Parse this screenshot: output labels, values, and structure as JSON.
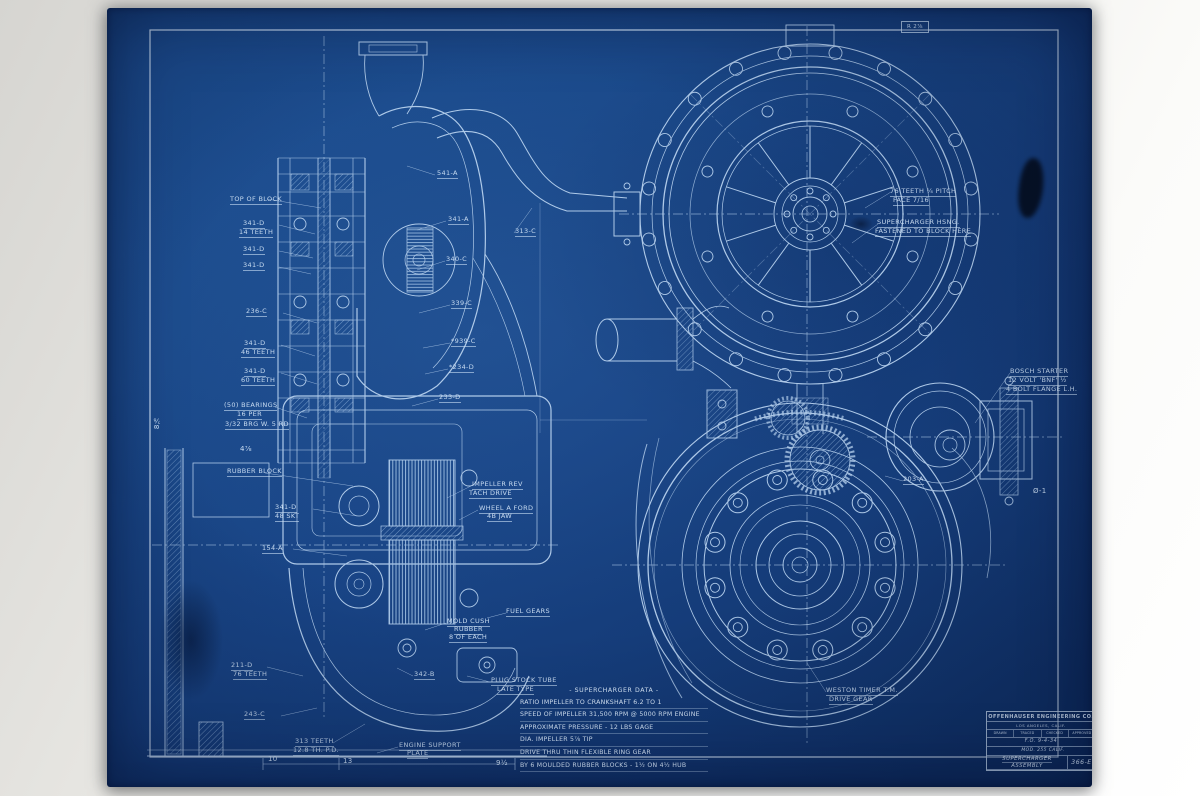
{
  "document": {
    "type": "blueprint-engineering-drawing",
    "sheet_color": "#184384",
    "line_color": "#b7d1ee",
    "text_color": "#d3e5f8"
  },
  "title_block": {
    "company": "OFFENHAUSER ENGINEERING CO.",
    "city": "LOS ANGELES, CALIF.",
    "headers": [
      "DRAWN",
      "TRACED",
      "CHECKED",
      "APPROVED"
    ],
    "values": "F.O.   9-4-34",
    "model": "MOD. 255 CALIF.",
    "title_line1": "SUPERCHARGER",
    "title_line2": "ASSEMBLY",
    "number": "366-E"
  },
  "notes": {
    "lines": [
      "- SUPERCHARGER DATA -",
      "RATIO IMPELLER TO CRANKSHAFT 6.2 TO 1",
      "SPEED OF IMPELLER 31,500 RPM @ 5000 RPM ENGINE",
      "APPROXIMATE PRESSURE - 12 LBS GAGE",
      "DIA. IMPELLER 5⅞ TIP",
      "DRIVE THRU THIN FLEXIBLE RING GEAR",
      "BY 6 MOULDED RUBBER BLOCKS - 1½ ON 4½ HUB"
    ]
  },
  "labels": [
    {
      "t": "TOP OF BLOCK",
      "x": 123,
      "y": 188,
      "u": true
    },
    {
      "t": "341-D",
      "x": 136,
      "y": 212,
      "u": true
    },
    {
      "t": "14 TEETH",
      "x": 132,
      "y": 221,
      "u": true
    },
    {
      "t": "341-D",
      "x": 136,
      "y": 238,
      "u": true
    },
    {
      "t": "341-D",
      "x": 136,
      "y": 254,
      "u": true
    },
    {
      "t": "236-C",
      "x": 139,
      "y": 300,
      "u": true
    },
    {
      "t": "341-D",
      "x": 137,
      "y": 332,
      "u": true
    },
    {
      "t": "46 TEETH",
      "x": 134,
      "y": 341,
      "u": true
    },
    {
      "t": "341-D",
      "x": 137,
      "y": 360,
      "u": true
    },
    {
      "t": "60 TEETH",
      "x": 134,
      "y": 369,
      "u": true
    },
    {
      "t": "(50) BEARINGS",
      "x": 117,
      "y": 394,
      "u": true
    },
    {
      "t": "16 PER",
      "x": 130,
      "y": 403,
      "u": true
    },
    {
      "t": "3/32 BRG W. 5 RD",
      "x": 118,
      "y": 413,
      "u": true
    },
    {
      "t": "4⅞",
      "x": 133,
      "y": 437,
      "cls": "dim"
    },
    {
      "t": "RUBBER BLOCK",
      "x": 120,
      "y": 460,
      "u": true
    },
    {
      "t": "341-D",
      "x": 168,
      "y": 496,
      "u": true
    },
    {
      "t": "48 SKT",
      "x": 168,
      "y": 505,
      "u": true
    },
    {
      "t": "154-A",
      "x": 155,
      "y": 537,
      "u": true
    },
    {
      "t": "8⅞",
      "x": 46,
      "y": 408,
      "cls": "dim vert"
    },
    {
      "t": "211-D",
      "x": 124,
      "y": 654,
      "u": true
    },
    {
      "t": "76 TEETH",
      "x": 126,
      "y": 663,
      "u": true
    },
    {
      "t": "243-C",
      "x": 137,
      "y": 703,
      "u": true
    },
    {
      "t": "313 TEETH",
      "x": 188,
      "y": 730,
      "u": true
    },
    {
      "t": "12.8 TH. P.D.",
      "x": 186,
      "y": 739,
      "u": true
    },
    {
      "t": "541-A",
      "x": 330,
      "y": 162,
      "u": true
    },
    {
      "t": "341-A",
      "x": 341,
      "y": 208,
      "u": true
    },
    {
      "t": "313-C",
      "x": 408,
      "y": 220,
      "u": true
    },
    {
      "t": "340-C",
      "x": 339,
      "y": 248,
      "u": true
    },
    {
      "t": "339-C",
      "x": 344,
      "y": 292,
      "u": true
    },
    {
      "t": "*939-C",
      "x": 344,
      "y": 330,
      "u": true
    },
    {
      "t": "*234-D",
      "x": 342,
      "y": 356,
      "u": true
    },
    {
      "t": "233-D",
      "x": 332,
      "y": 386,
      "u": true
    },
    {
      "t": "IMPELLER REV",
      "x": 365,
      "y": 473,
      "u": true
    },
    {
      "t": "TACH DRIVE",
      "x": 362,
      "y": 482,
      "u": true
    },
    {
      "t": "WHEEL A FORD",
      "x": 372,
      "y": 497,
      "u": true
    },
    {
      "t": "4B JAW",
      "x": 380,
      "y": 505,
      "u": true
    },
    {
      "t": "FUEL GEARS",
      "x": 399,
      "y": 600,
      "u": true
    },
    {
      "t": "MOLD CUSH",
      "x": 340,
      "y": 610,
      "u": true
    },
    {
      "t": "RUBBER",
      "x": 347,
      "y": 618,
      "u": true
    },
    {
      "t": "8 OF EACH",
      "x": 342,
      "y": 626,
      "u": true
    },
    {
      "t": "342-B",
      "x": 307,
      "y": 663,
      "u": true
    },
    {
      "t": "PLUG STOCK TUBE",
      "x": 384,
      "y": 669,
      "u": true
    },
    {
      "t": "LATE TYPE",
      "x": 390,
      "y": 678,
      "u": true
    },
    {
      "t": "ENGINE SUPPORT",
      "x": 292,
      "y": 734,
      "u": true
    },
    {
      "t": "PLATE",
      "x": 300,
      "y": 742,
      "u": true
    },
    {
      "t": "10",
      "x": 161,
      "y": 747,
      "cls": "dim"
    },
    {
      "t": "13",
      "x": 236,
      "y": 749,
      "cls": "dim"
    },
    {
      "t": "9½",
      "x": 389,
      "y": 751,
      "cls": "dim"
    },
    {
      "t": "R 2⅞",
      "x": 794,
      "y": 13,
      "cls": "box"
    },
    {
      "t": "76 TEETH ¼ PITCH",
      "x": 783,
      "y": 180,
      "u": true
    },
    {
      "t": "FACE 7/16",
      "x": 786,
      "y": 189,
      "u": true
    },
    {
      "t": "SUPERCHARGER HSNG.",
      "x": 770,
      "y": 211,
      "u": true
    },
    {
      "t": "FASTENED TO BLOCK HERE",
      "x": 768,
      "y": 220,
      "u": true
    },
    {
      "t": "BOSCH STARTER",
      "x": 903,
      "y": 360,
      "u": true
    },
    {
      "t": "12 VOLT 'BNF' ½",
      "x": 901,
      "y": 369,
      "u": true
    },
    {
      "t": "4 BOLT FLANGE L.H.",
      "x": 899,
      "y": 378,
      "u": true
    },
    {
      "t": "203-A",
      "x": 796,
      "y": 468,
      "u": true
    },
    {
      "t": "Ø-1",
      "x": 926,
      "y": 479,
      "cls": "dim"
    },
    {
      "t": "WESTON TIMER T.M.",
      "x": 719,
      "y": 679,
      "u": true
    },
    {
      "t": "DRIVE GEAR",
      "x": 722,
      "y": 688,
      "u": true
    }
  ]
}
